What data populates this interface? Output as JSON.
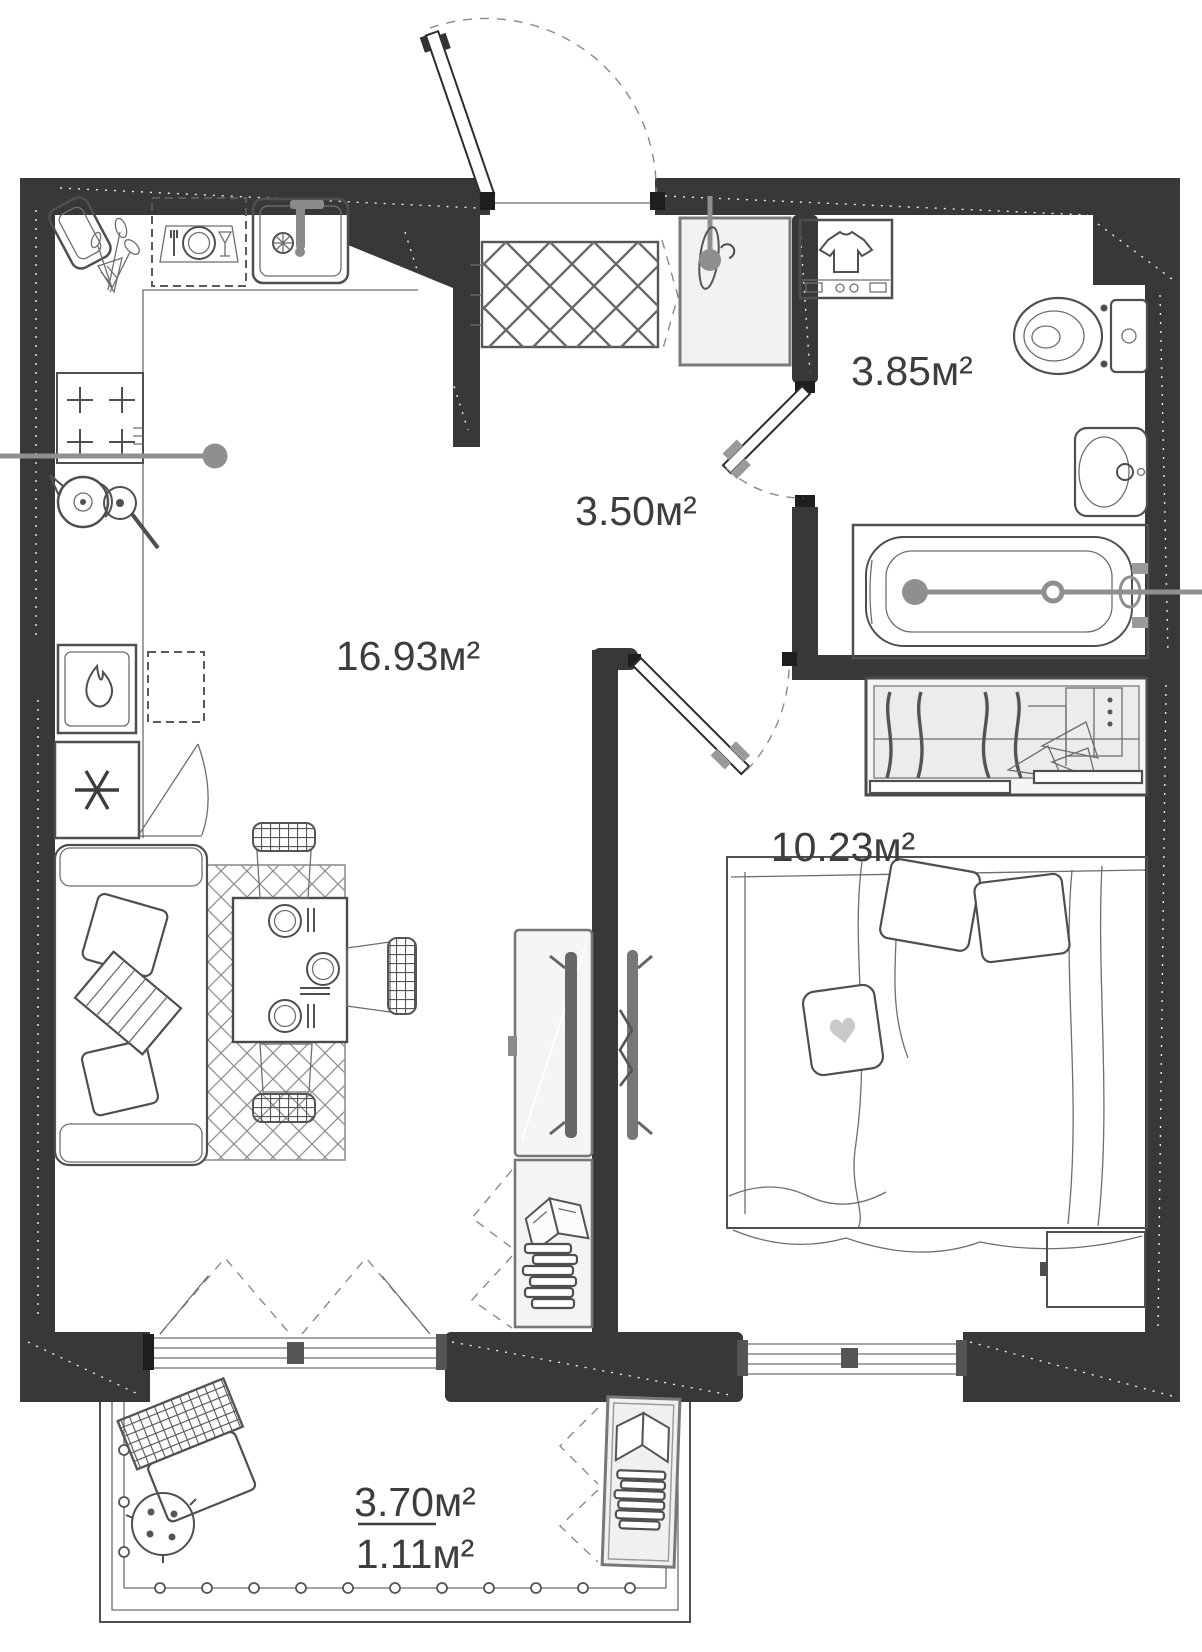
{
  "plan": {
    "type": "apartment-floor-plan",
    "rooms": [
      {
        "name": "kitchen-living-room",
        "area": "16.93м²"
      },
      {
        "name": "hallway",
        "area": "3.50м²"
      },
      {
        "name": "bathroom",
        "area": "3.85м²"
      },
      {
        "name": "bedroom",
        "area": "10.23м²"
      },
      {
        "name": "balcony",
        "area_full": "3.70м²",
        "area_reduced": "1.11м²"
      }
    ],
    "colors": {
      "wall": "#383838",
      "furniture_line": "#4f4f4f",
      "label_text": "#3d3d3d",
      "light_fill": "#f2f2f2",
      "section_rod": "#8f8f8f"
    }
  }
}
